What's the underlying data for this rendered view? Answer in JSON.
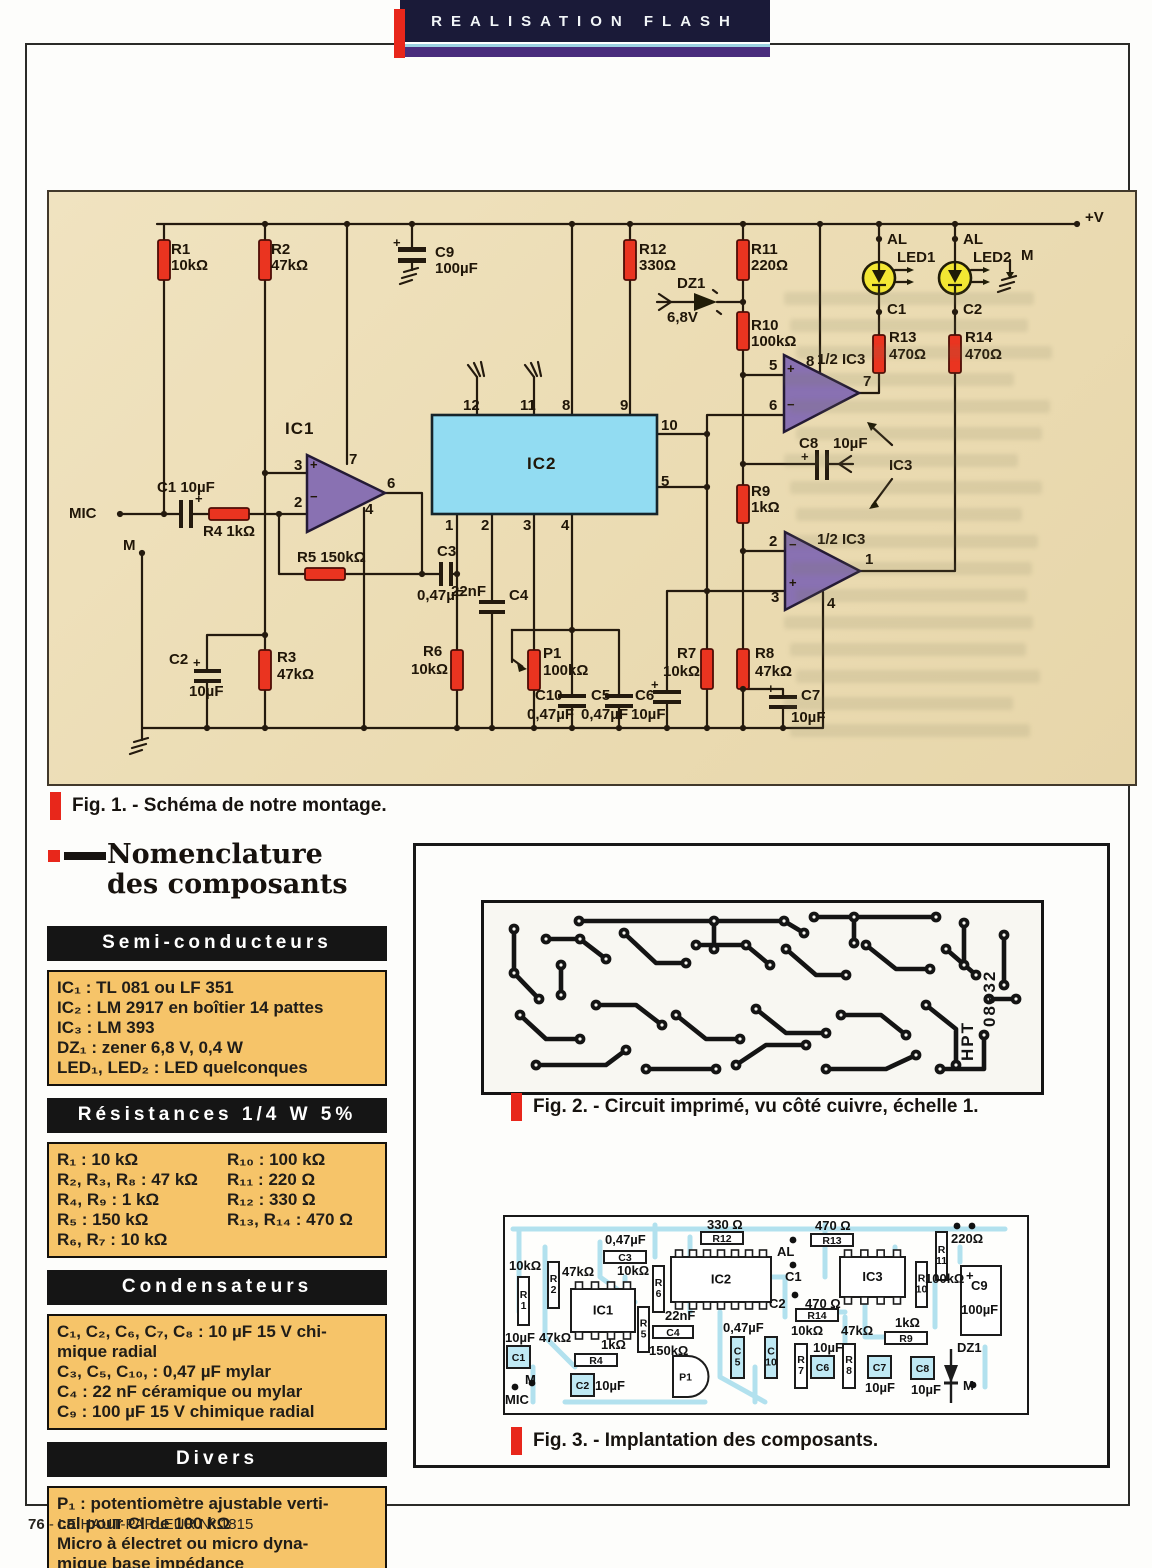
{
  "banner": {
    "title": "REALISATION FLASH"
  },
  "footer": {
    "page": "76",
    "text": " - LE HAUT-PARLEUR Nº 1815"
  },
  "fig1": {
    "caption": "Fig. 1. - Schéma de notre montage.",
    "labels": [
      {
        "t": "+V",
        "x": 1036,
        "y": 18
      },
      {
        "t": "R1",
        "x": 122,
        "y": 50
      },
      {
        "t": "10kΩ",
        "x": 122,
        "y": 66
      },
      {
        "t": "R2",
        "x": 222,
        "y": 50
      },
      {
        "t": "47kΩ",
        "x": 222,
        "y": 66
      },
      {
        "t": "+",
        "x": 344,
        "y": 44,
        "c": "pm"
      },
      {
        "t": "C9",
        "x": 386,
        "y": 53
      },
      {
        "t": "100µF",
        "x": 386,
        "y": 69
      },
      {
        "t": "R12",
        "x": 590,
        "y": 50
      },
      {
        "t": "330Ω",
        "x": 590,
        "y": 66
      },
      {
        "t": "R11",
        "x": 702,
        "y": 50
      },
      {
        "t": "220Ω",
        "x": 702,
        "y": 66
      },
      {
        "t": "DZ1",
        "x": 628,
        "y": 84
      },
      {
        "t": "6,8V",
        "x": 618,
        "y": 118
      },
      {
        "t": "R10",
        "x": 702,
        "y": 126
      },
      {
        "t": "100kΩ",
        "x": 702,
        "y": 142
      },
      {
        "t": "AL",
        "x": 838,
        "y": 40
      },
      {
        "t": "AL",
        "x": 914,
        "y": 40
      },
      {
        "t": "LED1",
        "x": 848,
        "y": 58
      },
      {
        "t": "LED2",
        "x": 924,
        "y": 58
      },
      {
        "t": "M",
        "x": 972,
        "y": 56
      },
      {
        "t": "C1",
        "x": 838,
        "y": 110
      },
      {
        "t": "C2",
        "x": 914,
        "y": 110
      },
      {
        "t": "R13",
        "x": 840,
        "y": 138
      },
      {
        "t": "470Ω",
        "x": 840,
        "y": 155
      },
      {
        "t": "R14",
        "x": 916,
        "y": 138
      },
      {
        "t": "470Ω",
        "x": 916,
        "y": 155
      },
      {
        "t": "1/2 IC3",
        "x": 768,
        "y": 160
      },
      {
        "t": "5",
        "x": 720,
        "y": 166
      },
      {
        "t": "6",
        "x": 720,
        "y": 206
      },
      {
        "t": "8",
        "x": 757,
        "y": 162
      },
      {
        "t": "7",
        "x": 814,
        "y": 182
      },
      {
        "t": "+",
        "x": 738,
        "y": 170,
        "c": "pm"
      },
      {
        "t": "−",
        "x": 738,
        "y": 206,
        "c": "pm"
      },
      {
        "t": "C8",
        "x": 750,
        "y": 244
      },
      {
        "t": "10µF",
        "x": 784,
        "y": 244
      },
      {
        "t": "+",
        "x": 752,
        "y": 258,
        "c": "pm"
      },
      {
        "t": "IC3",
        "x": 840,
        "y": 266
      },
      {
        "t": "R9",
        "x": 702,
        "y": 292
      },
      {
        "t": "1kΩ",
        "x": 702,
        "y": 308
      },
      {
        "t": "1/2 IC3",
        "x": 768,
        "y": 340
      },
      {
        "t": "2",
        "x": 720,
        "y": 342
      },
      {
        "t": "3",
        "x": 722,
        "y": 398
      },
      {
        "t": "1",
        "x": 816,
        "y": 360
      },
      {
        "t": "4",
        "x": 778,
        "y": 404
      },
      {
        "t": "−",
        "x": 740,
        "y": 346,
        "c": "pm"
      },
      {
        "t": "+",
        "x": 740,
        "y": 384,
        "c": "pm"
      },
      {
        "t": "IC1",
        "x": 236,
        "y": 228,
        "c": "big"
      },
      {
        "t": "3",
        "x": 245,
        "y": 266
      },
      {
        "t": "7",
        "x": 300,
        "y": 260
      },
      {
        "t": "6",
        "x": 338,
        "y": 284
      },
      {
        "t": "2",
        "x": 245,
        "y": 303
      },
      {
        "t": "4",
        "x": 316,
        "y": 310
      },
      {
        "t": "+",
        "x": 261,
        "y": 266,
        "c": "pm"
      },
      {
        "t": "−",
        "x": 261,
        "y": 298,
        "c": "pm"
      },
      {
        "t": "IC2",
        "x": 478,
        "y": 263,
        "c": "big"
      },
      {
        "t": "12",
        "x": 414,
        "y": 206
      },
      {
        "t": "11",
        "x": 471,
        "y": 206
      },
      {
        "t": "8",
        "x": 513,
        "y": 206
      },
      {
        "t": "9",
        "x": 571,
        "y": 206
      },
      {
        "t": "10",
        "x": 612,
        "y": 226
      },
      {
        "t": "5",
        "x": 612,
        "y": 282
      },
      {
        "t": "1",
        "x": 396,
        "y": 326
      },
      {
        "t": "2",
        "x": 432,
        "y": 326
      },
      {
        "t": "3",
        "x": 474,
        "y": 326
      },
      {
        "t": "4",
        "x": 512,
        "y": 326
      },
      {
        "t": "MIC",
        "x": 20,
        "y": 314
      },
      {
        "t": "C1 10µF",
        "x": 108,
        "y": 288
      },
      {
        "t": "+",
        "x": 146,
        "y": 300,
        "c": "pm"
      },
      {
        "t": "R4 1kΩ",
        "x": 154,
        "y": 332
      },
      {
        "t": "M",
        "x": 74,
        "y": 346
      },
      {
        "t": "R5 150kΩ",
        "x": 248,
        "y": 358
      },
      {
        "t": "C3",
        "x": 388,
        "y": 352
      },
      {
        "t": "0,47µF",
        "x": 368,
        "y": 396
      },
      {
        "t": "C2",
        "x": 120,
        "y": 460
      },
      {
        "t": "+",
        "x": 144,
        "y": 464,
        "c": "pm"
      },
      {
        "t": "10µF",
        "x": 140,
        "y": 492
      },
      {
        "t": "R3",
        "x": 228,
        "y": 458
      },
      {
        "t": "47kΩ",
        "x": 228,
        "y": 475
      },
      {
        "t": "R6",
        "x": 374,
        "y": 452
      },
      {
        "t": "10kΩ",
        "x": 362,
        "y": 470
      },
      {
        "t": "22nF",
        "x": 402,
        "y": 392
      },
      {
        "t": "C4",
        "x": 460,
        "y": 396
      },
      {
        "t": "P1",
        "x": 494,
        "y": 454
      },
      {
        "t": "100kΩ",
        "x": 494,
        "y": 471
      },
      {
        "t": "C10",
        "x": 486,
        "y": 496
      },
      {
        "t": "0,47µF",
        "x": 478,
        "y": 515
      },
      {
        "t": "C5",
        "x": 542,
        "y": 496
      },
      {
        "t": "0,47µF",
        "x": 532,
        "y": 515
      },
      {
        "t": "+",
        "x": 602,
        "y": 486,
        "c": "pm"
      },
      {
        "t": "C6",
        "x": 586,
        "y": 496
      },
      {
        "t": "10µF",
        "x": 582,
        "y": 515
      },
      {
        "t": "R7",
        "x": 628,
        "y": 454
      },
      {
        "t": "10kΩ",
        "x": 614,
        "y": 472
      },
      {
        "t": "R8",
        "x": 706,
        "y": 454
      },
      {
        "t": "47kΩ",
        "x": 706,
        "y": 472
      },
      {
        "t": "+",
        "x": 718,
        "y": 490,
        "c": "pm"
      },
      {
        "t": "C7",
        "x": 752,
        "y": 496
      },
      {
        "t": "10µF",
        "x": 742,
        "y": 518
      }
    ]
  },
  "fig2": {
    "caption": "Fig. 2. - Circuit imprimé, vu côté cuivre, échelle 1.",
    "board_marking_line1": "HPT",
    "board_marking_line2": "08932"
  },
  "fig3": {
    "caption": "Fig. 3. - Implantation des composants.",
    "parts": [
      {
        "kind": "ic",
        "x": 66,
        "y": 72,
        "w": 64,
        "h": 43,
        "label": "IC1",
        "pins": 4
      },
      {
        "kind": "ic",
        "x": 166,
        "y": 40,
        "w": 100,
        "h": 45,
        "label": "IC2",
        "pins": 7
      },
      {
        "kind": "ic",
        "x": 335,
        "y": 40,
        "w": 65,
        "h": 40,
        "label": "IC3",
        "pins": 4
      },
      {
        "kind": "rect",
        "x": 456,
        "y": 49,
        "w": 40,
        "h": 69,
        "label": ""
      },
      {
        "kind": "rect",
        "x": 13,
        "y": 60,
        "w": 11,
        "h": 48,
        "label": "R1",
        "stack": 1
      },
      {
        "kind": "rect",
        "x": 43,
        "y": 45,
        "w": 11,
        "h": 46,
        "label": "R2",
        "stack": 1
      },
      {
        "kind": "rect",
        "x": 148,
        "y": 49,
        "w": 11,
        "h": 46,
        "label": "R6",
        "stack": 1
      },
      {
        "kind": "rect",
        "x": 133,
        "y": 90,
        "w": 11,
        "h": 45,
        "label": "R5",
        "stack": 1
      },
      {
        "kind": "rect",
        "x": 290,
        "y": 127,
        "w": 12,
        "h": 44,
        "label": "R7",
        "stack": 1
      },
      {
        "kind": "rect",
        "x": 338,
        "y": 127,
        "w": 12,
        "h": 44,
        "label": "R8",
        "stack": 1
      },
      {
        "kind": "rect",
        "x": 411,
        "y": 45,
        "w": 11,
        "h": 45,
        "label": "R10",
        "stack": 1
      },
      {
        "kind": "rect",
        "x": 431,
        "y": 15,
        "w": 11,
        "h": 48,
        "label": "R11",
        "stack": 1
      },
      {
        "kind": "rect",
        "x": 99,
        "y": 34,
        "w": 42,
        "h": 12,
        "label": "C3"
      },
      {
        "kind": "rect",
        "x": 196,
        "y": 15,
        "w": 42,
        "h": 12,
        "label": "R12"
      },
      {
        "kind": "rect",
        "x": 306,
        "y": 17,
        "w": 42,
        "h": 12,
        "label": "R13"
      },
      {
        "kind": "rect",
        "x": 291,
        "y": 92,
        "w": 42,
        "h": 12,
        "label": "R14"
      },
      {
        "kind": "rect",
        "x": 380,
        "y": 115,
        "w": 42,
        "h": 12,
        "label": "R9"
      },
      {
        "kind": "rect",
        "x": 70,
        "y": 137,
        "w": 42,
        "h": 12,
        "label": "R4"
      },
      {
        "kind": "rect",
        "x": 148,
        "y": 109,
        "w": 40,
        "h": 12,
        "label": "C4"
      },
      {
        "kind": "cap",
        "x": 2,
        "y": 129,
        "w": 23,
        "h": 22,
        "label": "C1"
      },
      {
        "kind": "cap",
        "x": 66,
        "y": 157,
        "w": 23,
        "h": 22,
        "label": "C2"
      },
      {
        "kind": "cap",
        "x": 226,
        "y": 120,
        "w": 13,
        "h": 41,
        "label": "C5",
        "stack": 1
      },
      {
        "kind": "cap",
        "x": 260,
        "y": 120,
        "w": 12,
        "h": 41,
        "label": "C10",
        "stack": 1
      },
      {
        "kind": "cap",
        "x": 306,
        "y": 139,
        "w": 23,
        "h": 22,
        "label": "C6"
      },
      {
        "kind": "cap",
        "x": 363,
        "y": 139,
        "w": 23,
        "h": 22,
        "label": "C7"
      },
      {
        "kind": "cap",
        "x": 406,
        "y": 140,
        "w": 23,
        "h": 22,
        "label": "C8"
      },
      {
        "kind": "pot",
        "x": 168,
        "y": 139,
        "w": 33,
        "h": 41,
        "label": "P1"
      },
      {
        "kind": "diode",
        "x": 446,
        "y": 132,
        "h": 54,
        "label": ""
      }
    ],
    "labels": [
      {
        "t": "10kΩ",
        "x": 4,
        "y": 42
      },
      {
        "t": "47kΩ",
        "x": 57,
        "y": 48
      },
      {
        "t": "0,47µF",
        "x": 100,
        "y": 16
      },
      {
        "t": "330 Ω",
        "x": 202,
        "y": 1
      },
      {
        "t": "470 Ω",
        "x": 310,
        "y": 2
      },
      {
        "t": "AL",
        "x": 272,
        "y": 28
      },
      {
        "t": "C1",
        "x": 280,
        "y": 53
      },
      {
        "t": "C2",
        "x": 264,
        "y": 80
      },
      {
        "t": "470 Ω",
        "x": 300,
        "y": 80
      },
      {
        "t": "220Ω",
        "x": 446,
        "y": 15
      },
      {
        "t": "10kΩ",
        "x": 112,
        "y": 47
      },
      {
        "t": "22nF",
        "x": 160,
        "y": 92
      },
      {
        "t": "150kΩ",
        "x": 144,
        "y": 127
      },
      {
        "t": "0,47µF",
        "x": 218,
        "y": 104
      },
      {
        "t": "10kΩ",
        "x": 286,
        "y": 107
      },
      {
        "t": "10µF",
        "x": 308,
        "y": 124
      },
      {
        "t": "47kΩ",
        "x": 336,
        "y": 107
      },
      {
        "t": "1kΩ",
        "x": 390,
        "y": 99
      },
      {
        "t": "10µF",
        "x": 360,
        "y": 164
      },
      {
        "t": "10µF",
        "x": 406,
        "y": 166
      },
      {
        "t": "DZ1",
        "x": 452,
        "y": 124
      },
      {
        "t": "100kΩ",
        "x": 420,
        "y": 55
      },
      {
        "t": "C9",
        "x": 466,
        "y": 62
      },
      {
        "t": "100µF",
        "x": 456,
        "y": 86
      },
      {
        "t": "+",
        "x": 461,
        "y": 52
      },
      {
        "t": "M",
        "x": 458,
        "y": 162
      },
      {
        "t": "MIC",
        "x": 0,
        "y": 176
      },
      {
        "t": "M",
        "x": 20,
        "y": 156
      },
      {
        "t": "10µF",
        "x": 0,
        "y": 114
      },
      {
        "t": "47kΩ",
        "x": 34,
        "y": 114
      },
      {
        "t": "1kΩ",
        "x": 96,
        "y": 121
      },
      {
        "t": "10µF",
        "x": 90,
        "y": 162
      }
    ]
  },
  "nomenclature": {
    "title1": "Nomenclature",
    "title2": "des composants",
    "sections": [
      {
        "header": "Semi-conducteurs",
        "lines": [
          "IC₁ : TL 081 ou LF 351",
          "IC₂ : LM 2917 en boîtier 14 pattes",
          "IC₃ : LM 393",
          "DZ₁ : zener 6,8 V, 0,4 W",
          "LED₁, LED₂ : LED quelconques"
        ]
      },
      {
        "header": "Résistances 1/4 W 5%",
        "col1": [
          "R₁ : 10 kΩ",
          "R₂, R₃, R₈ : 47 kΩ",
          "R₄, R₉ : 1 kΩ",
          "R₅ : 150 kΩ",
          "R₆, R₇ : 10 kΩ"
        ],
        "col2": [
          "R₁₀ : 100 kΩ",
          "R₁₁ : 220 Ω",
          "R₁₂ : 330 Ω",
          "R₁₃, R₁₄ : 470 Ω"
        ]
      },
      {
        "header": "Condensateurs",
        "lines": [
          "C₁, C₂, C₆, C₇, C₈ : 10 µF 15 V chi-",
          "mique radial",
          "C₃, C₅, C₁₀, : 0,47 µF mylar",
          "C₄ : 22 nF céramique ou mylar",
          "C₉ : 100 µF 15 V chimique radial"
        ]
      },
      {
        "header": "Divers",
        "lines": [
          "P₁ : potentiomètre ajustable verti-",
          "cal pour CI de 100 kΩ",
          "Micro à électret ou micro dyna-",
          "mique base impédance"
        ]
      }
    ]
  }
}
